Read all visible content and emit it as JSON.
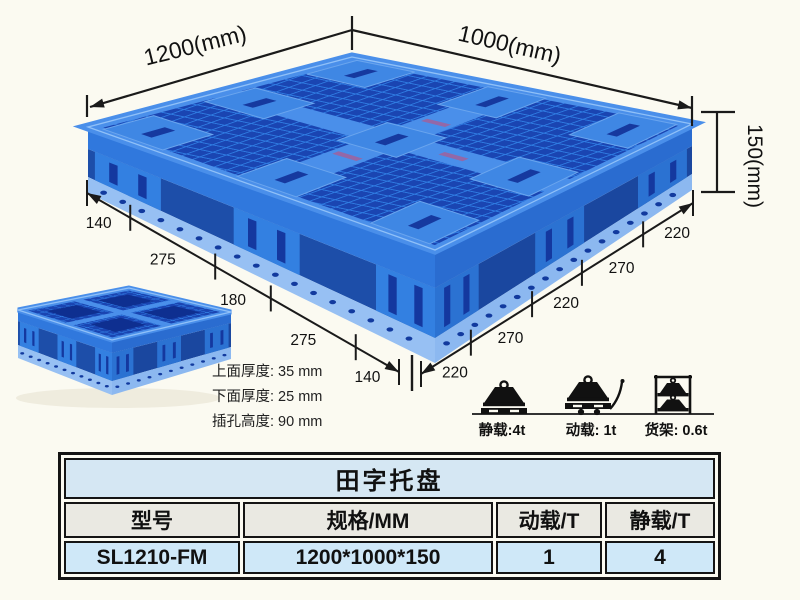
{
  "colors": {
    "background": "#fbfaf1",
    "pallet_blue": "#3078dd",
    "pallet_dark_hole": "#16399f",
    "pallet_rib": "#4a8fea",
    "pallet_skid": "#97c0f3",
    "ink": "#1a1a1a",
    "table_title_bg": "#d5e7f3",
    "table_header_bg": "#eae9e2",
    "table_data_bg": "#cfe8f8"
  },
  "diagram": {
    "dim_top_left": "1200(mm)",
    "dim_top_right": "1000(mm)",
    "dim_height": "150(mm)",
    "left_edge_segments": [
      "140",
      "275",
      "180",
      "275",
      "140"
    ],
    "right_edge_segments": [
      "220",
      "270",
      "220",
      "270",
      "220"
    ],
    "thickness_notes": [
      "上面厚度: 35 mm",
      "下面厚度: 25 mm",
      "插孔高度: 90 mm"
    ],
    "load_ratings": [
      {
        "icon": "static-load-icon",
        "label": "静载:4t"
      },
      {
        "icon": "dynamic-load-icon",
        "label": "动载: 1t"
      },
      {
        "icon": "rack-load-icon",
        "label": "货架: 0.6t"
      }
    ]
  },
  "table": {
    "title": "田字托盘",
    "headers": [
      "型号",
      "规格/MM",
      "动载/T",
      "静载/T"
    ],
    "rows": [
      [
        "SL1210-FM",
        "1200*1000*150",
        "1",
        "4"
      ]
    ]
  }
}
